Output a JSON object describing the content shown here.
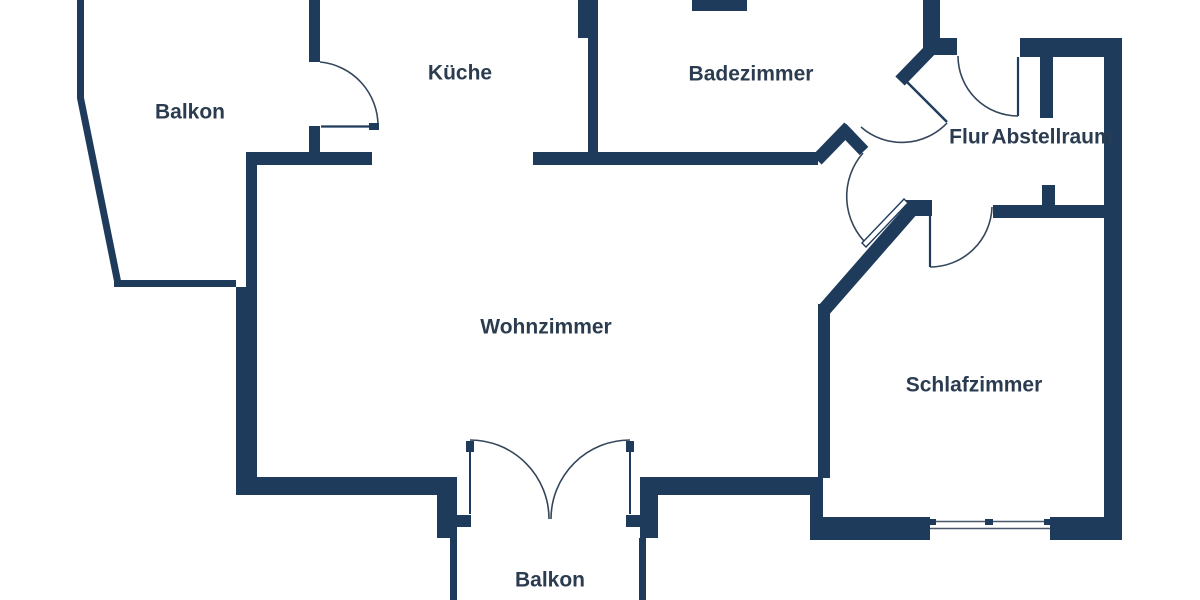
{
  "colors": {
    "background": "#ffffff",
    "wall": "#1f3b5c",
    "label": "#2b3c50",
    "arc_line": "#33465a",
    "window_line": "#49596b"
  },
  "rooms": {
    "balkon_top": {
      "label": "Balkon"
    },
    "kueche": {
      "label": "Küche"
    },
    "badezimmer": {
      "label": "Badezimmer"
    },
    "flur": {
      "label": "Flur"
    },
    "abstellraum": {
      "label": "Abstellraum"
    },
    "wohnzimmer": {
      "label": "Wohnzimmer"
    },
    "schlafzimmer": {
      "label": "Schlafzimmer"
    },
    "balkon_bottom": {
      "label": "Balkon"
    }
  }
}
